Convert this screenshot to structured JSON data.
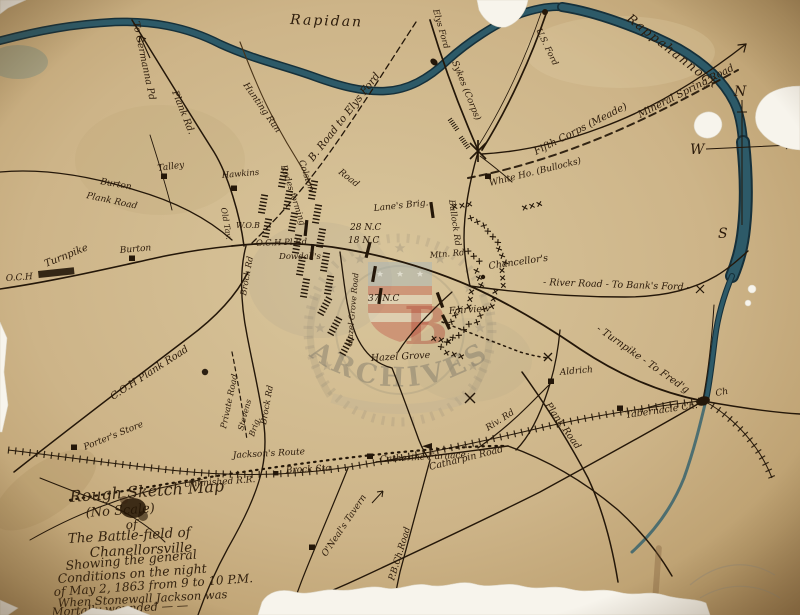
{
  "colors": {
    "paper": "#cdb488",
    "ink": "#241709",
    "river": "#2d5a68",
    "river_edge": "#16303a",
    "watermark_gray": "#807a6a",
    "watermark_red": "#b04434",
    "tear_white": "#f7f4ec"
  },
  "rivers": {
    "rapidan": "Rapidan",
    "rappahannock": "Rappahannock"
  },
  "compass": {
    "north": "N",
    "west": "W",
    "south": "S"
  },
  "watermark": {
    "arc_text": "ARCHIVES",
    "shield_letter": "B"
  },
  "labels": {
    "to_germanna": "To Germanna Pd",
    "plank_rd": "Plank Rd.",
    "hunting_run": "Hunting Run",
    "b_road_elys": "B. Road to Elys Ford",
    "elys_ford": "Elys Ford",
    "us_ford": "U.S. Ford",
    "sykes": "Sykes (Corps)",
    "mineral_spring": "Mineral Spring Road",
    "fifth_corps": "Fifth Corps (Meade)",
    "white_house": "White Ho. (Bullocks)",
    "bullock_rd": "Bullock Rd",
    "lanes_brig": "Lane's Brig.",
    "nc28": "28 N.C",
    "nc18": "18 N.C",
    "nc37": "37 N.C",
    "mtn_rd": "Mtn. Rd",
    "road_c": "Road",
    "colston": "Colston",
    "rodes": "Rodes forming",
    "wob": "W.O.B",
    "och_pl_rd": "O.C.H Pl.Rd",
    "dowdalls": "Dowdall's",
    "brock_rd_n": "Brock Rd",
    "brock_rd_s": "Brock Rd",
    "old_tav": "Old Tav.",
    "turnpike_w": "Turnpike",
    "och_w": "O.C.H",
    "burton_plank_1": "Burton",
    "burton_plank_2": "Plank Road",
    "talley": "Talley",
    "hawkins": "Hawkins",
    "burton": "Burton",
    "chancellors": "Chancellor's",
    "river_road": "- River Road - To Bank's Ford -",
    "turnpike_fredg": "- Turnpike - To Fred'g",
    "ch": "Ch",
    "tabernacle": "Tabernacle Ch.",
    "aldrich": "Aldrich",
    "plank_road_se": "Plank Road",
    "riv_rd": "Riv. Rd",
    "catharpin": "Catharpin Road",
    "catherine_furnace": "Catherine Furnace",
    "jacksons_route": "Jackson's Route",
    "brock_sta": "Brock Sta",
    "unfinished_rr": "Unfinished R.R.",
    "coh_plank": "C.O.H Plank Road",
    "porters_store": "Porter's Store",
    "private_road": "Private Road",
    "stevens": "Stevens",
    "brig": "Brig.",
    "oneals": "O'Neal's Tavern",
    "pbch_road": "P.B.Ch.Road",
    "fairview": "Fairview",
    "hazel_grove": "Hazel Grove",
    "hazel_grove_rd": "Hazel Grove Road"
  },
  "title_block": {
    "lines": [
      "Rough Sketch Map",
      "(No Scale)",
      "of",
      "The Battle-field of",
      "Chanellorsville",
      "Showing the general",
      "Conditions on the night",
      "of May 2, 1863 from 9 to 10 P.M.",
      "When Stonewall Jackson was",
      "Mortally wounded — —"
    ]
  }
}
